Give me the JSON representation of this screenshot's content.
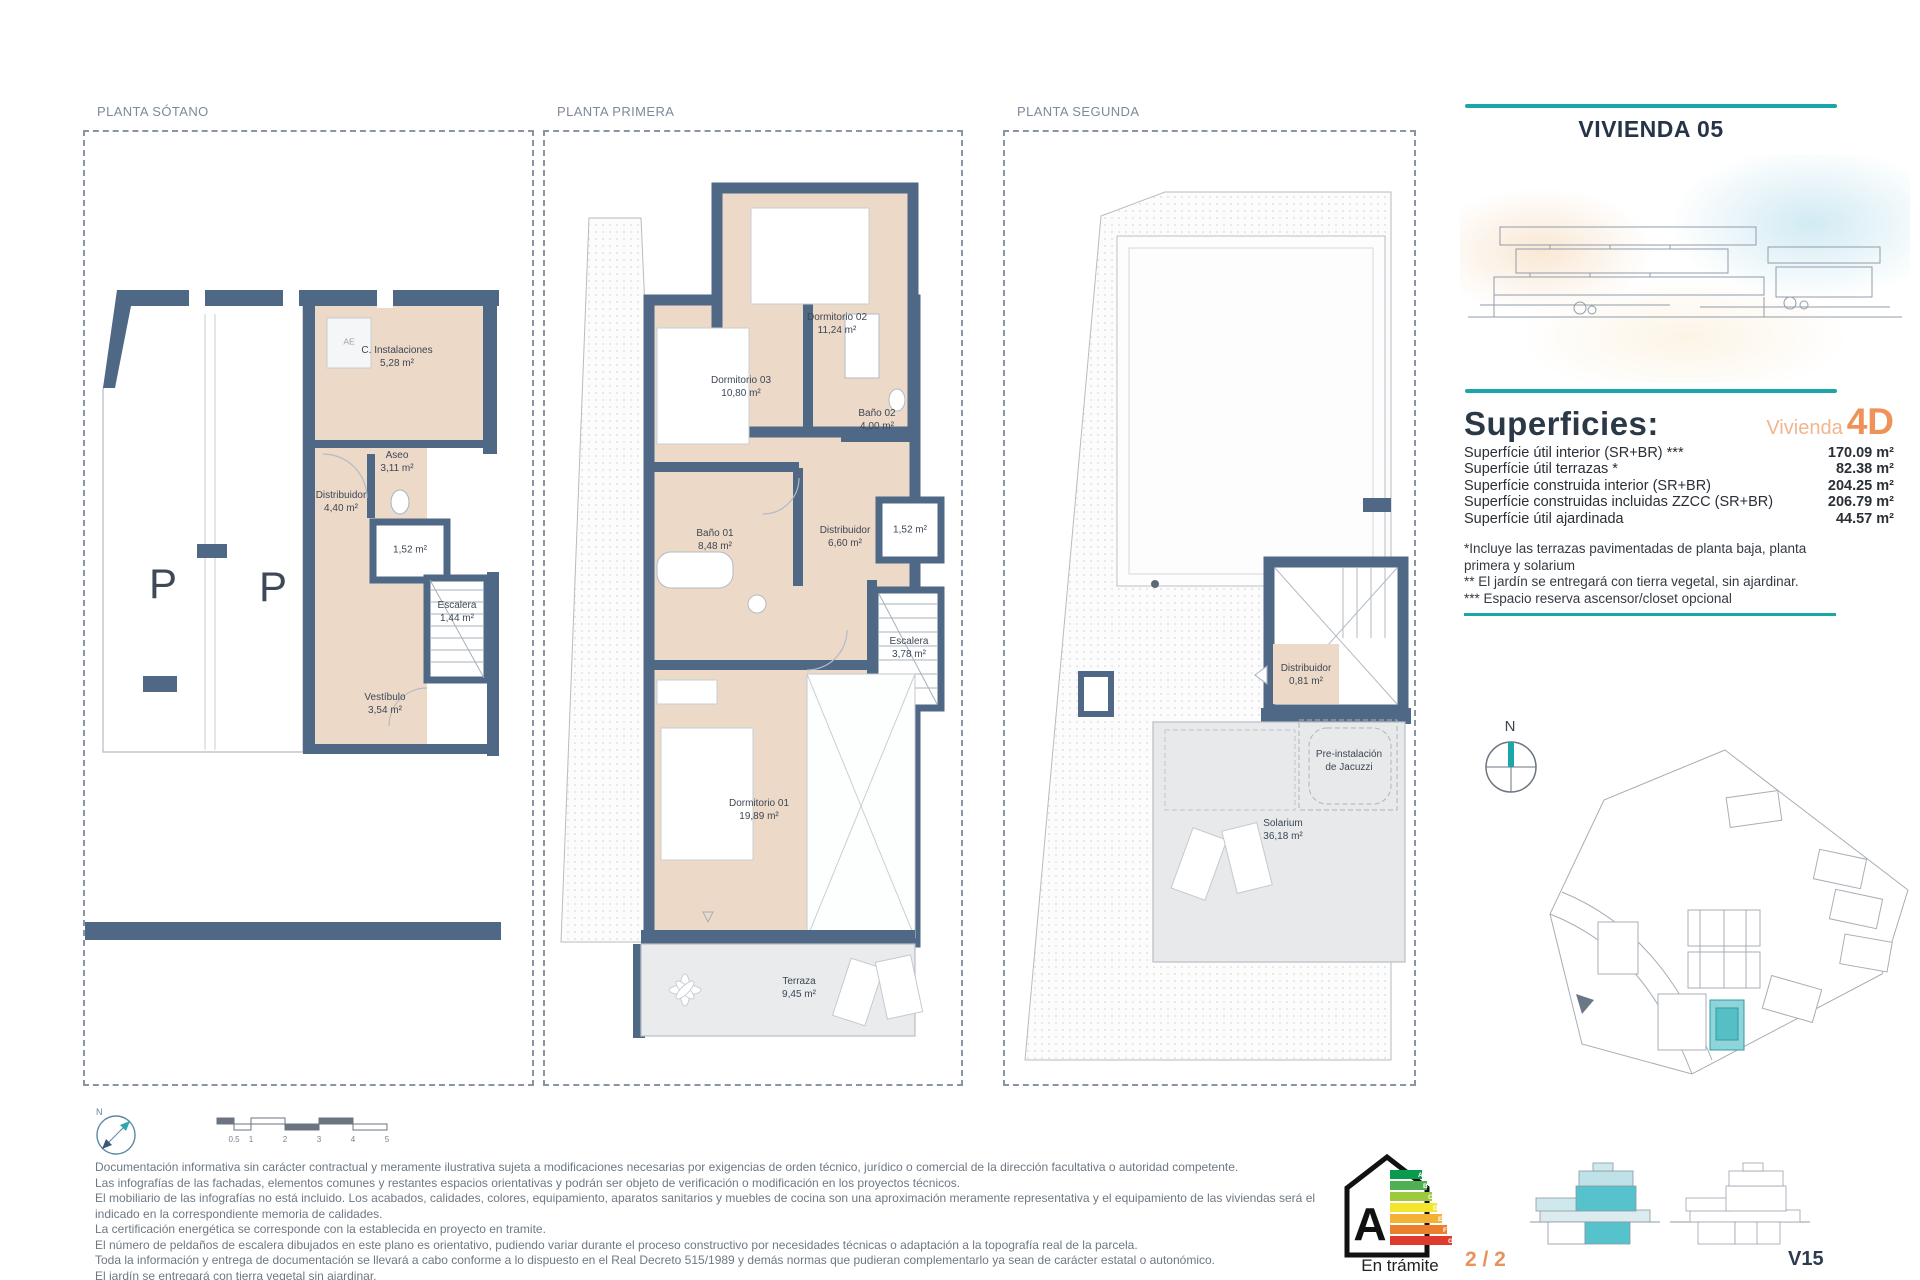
{
  "page": {
    "teal": "#1ba6a9",
    "orange": "#ee9258",
    "navy": "#263449"
  },
  "plans": [
    {
      "label": "PLANTA SÓTANO",
      "parking_letter": "P",
      "rooms": [
        {
          "name": "C. Instalaciones",
          "area": "5,28 m²"
        },
        {
          "name": "Aseo",
          "area": "3,11 m²"
        },
        {
          "name": "Distribuidor",
          "area": "4,40 m²"
        },
        {
          "name": "",
          "area": "1,52 m²"
        },
        {
          "name": "Escalera",
          "area": "1,44 m²"
        },
        {
          "name": "Vestíbulo",
          "area": "3,54 m²"
        },
        {
          "name": "AE",
          "area": ""
        }
      ]
    },
    {
      "label": "PLANTA PRIMERA",
      "rooms": [
        {
          "name": "Dormitorio 02",
          "area": "11,24 m²"
        },
        {
          "name": "Dormitorio 03",
          "area": "10,80 m²"
        },
        {
          "name": "Baño 02",
          "area": "4,00 m²"
        },
        {
          "name": "Distribuidor",
          "area": "6,60 m²"
        },
        {
          "name": "",
          "area": "1,52 m²"
        },
        {
          "name": "Baño 01",
          "area": "8,48 m²"
        },
        {
          "name": "Escalera",
          "area": "3,78 m²"
        },
        {
          "name": "Dormitorio 01",
          "area": "19,89 m²"
        },
        {
          "name": "Terraza",
          "area": "9,45 m²"
        }
      ]
    },
    {
      "label": "PLANTA SEGUNDA",
      "rooms": [
        {
          "name": "Distribuidor",
          "area": "0,81 m²"
        },
        {
          "name": "Solarium",
          "area": "36,18 m²"
        }
      ],
      "annotation": {
        "line1": "Pre-instalación",
        "line2": "de Jacuzzi"
      }
    }
  ],
  "sidebar": {
    "title": "VIVIENDA 05",
    "compass_label": "N",
    "superficies": {
      "heading": "Superficies:",
      "vivienda_label": "Vivienda",
      "vivienda_type": "4D",
      "rows": [
        {
          "label": "Superfície útil interior (SR+BR) ***",
          "value": "170.09 m²"
        },
        {
          "label": "Superfície útil terrazas *",
          "value": "82.38 m²"
        },
        {
          "label": "Superfície construida interior (SR+BR)",
          "value": "204.25 m²"
        },
        {
          "label": "Superfície construidas incluidas ZZCC (SR+BR)",
          "value": "206.79 m²"
        },
        {
          "label": "Superfície útil ajardinada",
          "value": "44.57 m²"
        }
      ],
      "notes": [
        "*Incluye las terrazas pavimentadas de planta baja, planta",
        "primera y solarium",
        "** El jardín se entregará con tierra vegetal, sin ajardinar.",
        "*** Espacio reserva ascensor/closet opcional"
      ]
    }
  },
  "footer": {
    "scalebar_ticks": [
      "0.5",
      "1",
      "2",
      "3",
      "4",
      "5"
    ],
    "disclaimer": [
      "Documentación informativa sin carácter contractual y meramente ilustrativa sujeta a modificaciones necesarias por exigencias de orden técnico, jurídico o comercial de la dirección facultativa o autoridad competente.",
      "Las infografías de las fachadas, elementos comunes y restantes espacios orientativas y podrán ser objeto de verificación o modificación en los proyectos técnicos.",
      "El mobiliario de las infografías no está incluido. Los acabados, calidades, colores, equipamiento, aparatos sanitarios y muebles de cocina son una aproximación meramente representativa y el equipamiento de las viviendas será el",
      "indicado en la correspondiente memoria de calidades.",
      "La certificación energética se corresponde con la establecida en proyecto en tramite.",
      "El número de peldaños de escalera dibujados en este plano es orientativo, pudiendo variar durante el proceso constructivo por necesidades técnicas o adaptación a la topografía real de la parcela.",
      "Toda la información y entrega de documentación se llevará a cabo conforme a lo dispuesto en el Real Decreto 515/1989 y demás normas que pudieran complementarlo ya sean de carácter estatal o autonómico.",
      "El jardín se entregará con tierra vegetal sin ajardinar."
    ],
    "energy": {
      "letter": "A",
      "status": "En trámite",
      "bars": [
        "A",
        "B",
        "C",
        "D",
        "E",
        "F",
        "G"
      ]
    },
    "sheet_number": "2 / 2",
    "sheet_code": "V15"
  }
}
